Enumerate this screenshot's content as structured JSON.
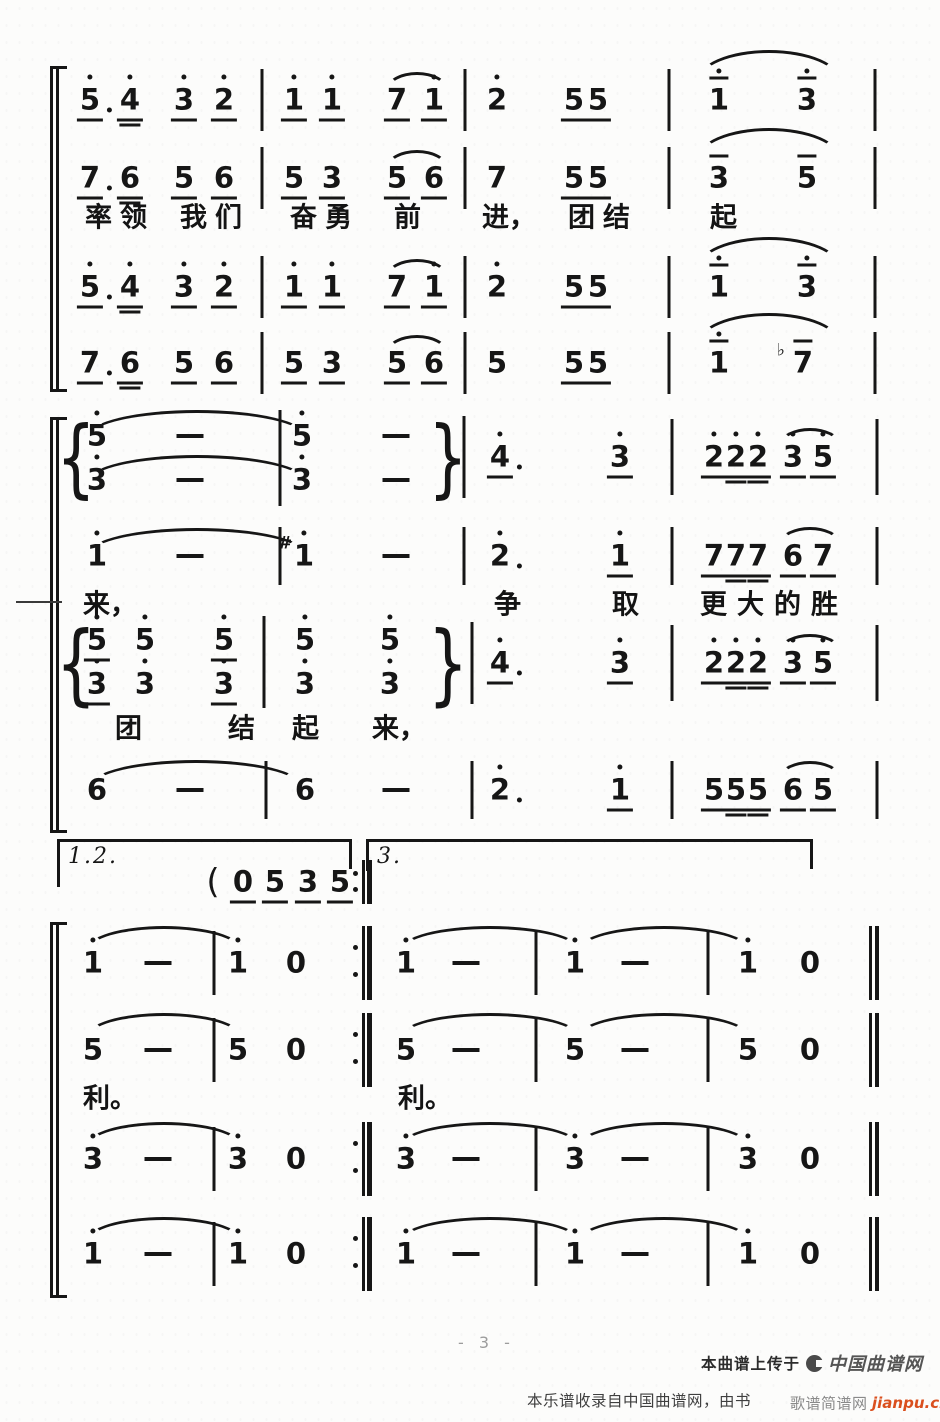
{
  "page": {
    "number_label": "- 3 -"
  },
  "footer": {
    "upload_prefix": "本曲谱上传于",
    "site_logo": "中国曲谱网",
    "source_note": "本乐谱收录自中国曲谱网，由书",
    "jianpu_site": "歌谱简谱网",
    "jianpu_domain": "jianpu.cn"
  },
  "colors": {
    "ink": "#161616",
    "paper": "#fcfcfb",
    "domain_red": "#da4f1e",
    "page_number_gray": "#9c9c9c"
  },
  "score": {
    "flag_legend": "d=octave dot above, u=single underline, U=double underline, o=overline, a=dot after, s=sharp, f=flat; '-'=duration dash, '0'=rest",
    "notes": [
      [
        90,
        100,
        "5",
        "dua"
      ],
      [
        130,
        100,
        "4",
        "dU"
      ],
      [
        184,
        100,
        "3",
        "du"
      ],
      [
        224,
        100,
        "2",
        "du"
      ],
      [
        294,
        100,
        "1",
        "du"
      ],
      [
        332,
        100,
        "1",
        "du"
      ],
      [
        397,
        100,
        "7",
        "u"
      ],
      [
        434,
        100,
        "1",
        "du"
      ],
      [
        497,
        100,
        "2",
        "d"
      ],
      [
        574,
        100,
        "5",
        "u"
      ],
      [
        598,
        100,
        "5",
        "u"
      ],
      [
        719,
        100,
        "1",
        "do"
      ],
      [
        807,
        100,
        "3",
        "do"
      ],
      [
        90,
        178,
        "7",
        "ua"
      ],
      [
        130,
        178,
        "6",
        "U"
      ],
      [
        184,
        178,
        "5",
        "u"
      ],
      [
        224,
        178,
        "6",
        "u"
      ],
      [
        294,
        178,
        "5",
        "u"
      ],
      [
        332,
        178,
        "3",
        "u"
      ],
      [
        397,
        178,
        "5",
        "u"
      ],
      [
        434,
        178,
        "6",
        "u"
      ],
      [
        497,
        178,
        "7",
        ""
      ],
      [
        574,
        178,
        "5",
        "u"
      ],
      [
        598,
        178,
        "5",
        "u"
      ],
      [
        719,
        178,
        "3",
        "o"
      ],
      [
        807,
        178,
        "5",
        "o"
      ],
      [
        90,
        287,
        "5",
        "dua"
      ],
      [
        130,
        287,
        "4",
        "dU"
      ],
      [
        184,
        287,
        "3",
        "du"
      ],
      [
        224,
        287,
        "2",
        "du"
      ],
      [
        294,
        287,
        "1",
        "du"
      ],
      [
        332,
        287,
        "1",
        "du"
      ],
      [
        397,
        287,
        "7",
        "u"
      ],
      [
        434,
        287,
        "1",
        "du"
      ],
      [
        497,
        287,
        "2",
        "d"
      ],
      [
        574,
        287,
        "5",
        "u"
      ],
      [
        598,
        287,
        "5",
        "u"
      ],
      [
        719,
        287,
        "1",
        "do"
      ],
      [
        807,
        287,
        "3",
        "do"
      ],
      [
        90,
        363,
        "7",
        "ua"
      ],
      [
        130,
        363,
        "6",
        "U"
      ],
      [
        184,
        363,
        "5",
        "u"
      ],
      [
        224,
        363,
        "6",
        "u"
      ],
      [
        294,
        363,
        "5",
        "u"
      ],
      [
        332,
        363,
        "3",
        "u"
      ],
      [
        397,
        363,
        "5",
        "u"
      ],
      [
        434,
        363,
        "6",
        "u"
      ],
      [
        497,
        363,
        "5",
        ""
      ],
      [
        574,
        363,
        "5",
        "u"
      ],
      [
        598,
        363,
        "5",
        "u"
      ],
      [
        719,
        363,
        "1",
        "do"
      ],
      [
        803,
        363,
        "7",
        "fo"
      ],
      [
        97,
        436,
        "5",
        "d"
      ],
      [
        190,
        436,
        "-",
        ""
      ],
      [
        302,
        436,
        "5",
        "d"
      ],
      [
        396,
        436,
        "-",
        ""
      ],
      [
        97,
        480,
        "3",
        "d"
      ],
      [
        190,
        480,
        "-",
        ""
      ],
      [
        302,
        480,
        "3",
        "d"
      ],
      [
        396,
        480,
        "-",
        ""
      ],
      [
        500,
        457,
        "4",
        "dua"
      ],
      [
        620,
        457,
        "3",
        "du"
      ],
      [
        714,
        457,
        "2",
        "du"
      ],
      [
        736,
        457,
        "2",
        "dU"
      ],
      [
        758,
        457,
        "2",
        "dU"
      ],
      [
        793,
        457,
        "3",
        "du"
      ],
      [
        823,
        457,
        "5",
        "du"
      ],
      [
        97,
        556,
        "1",
        "d"
      ],
      [
        190,
        556,
        "-",
        ""
      ],
      [
        304,
        556,
        "1",
        "ds"
      ],
      [
        396,
        556,
        "-",
        ""
      ],
      [
        500,
        556,
        "2",
        "da"
      ],
      [
        620,
        556,
        "1",
        "du"
      ],
      [
        714,
        556,
        "7",
        "u"
      ],
      [
        736,
        556,
        "7",
        "U"
      ],
      [
        758,
        556,
        "7",
        "U"
      ],
      [
        793,
        556,
        "6",
        "u"
      ],
      [
        823,
        556,
        "7",
        "u"
      ],
      [
        97,
        640,
        "5",
        "du"
      ],
      [
        145,
        640,
        "5",
        "d"
      ],
      [
        224,
        640,
        "5",
        "du"
      ],
      [
        305,
        640,
        "5",
        "d"
      ],
      [
        390,
        640,
        "5",
        "d"
      ],
      [
        97,
        684,
        "3",
        "du"
      ],
      [
        145,
        684,
        "3",
        "d"
      ],
      [
        224,
        684,
        "3",
        "du"
      ],
      [
        305,
        684,
        "3",
        "d"
      ],
      [
        390,
        684,
        "3",
        "d"
      ],
      [
        500,
        663,
        "4",
        "dua"
      ],
      [
        620,
        663,
        "3",
        "du"
      ],
      [
        714,
        663,
        "2",
        "du"
      ],
      [
        736,
        663,
        "2",
        "dU"
      ],
      [
        758,
        663,
        "2",
        "dU"
      ],
      [
        793,
        663,
        "3",
        "du"
      ],
      [
        823,
        663,
        "5",
        "du"
      ],
      [
        97,
        790,
        "6",
        ""
      ],
      [
        190,
        790,
        "-",
        ""
      ],
      [
        305,
        790,
        "6",
        ""
      ],
      [
        396,
        790,
        "-",
        ""
      ],
      [
        500,
        790,
        "2",
        "da"
      ],
      [
        620,
        790,
        "1",
        "du"
      ],
      [
        714,
        790,
        "5",
        "u"
      ],
      [
        736,
        790,
        "5",
        "U"
      ],
      [
        758,
        790,
        "5",
        "U"
      ],
      [
        793,
        790,
        "6",
        "u"
      ],
      [
        823,
        790,
        "5",
        "u"
      ],
      [
        213,
        882,
        "(",
        ""
      ],
      [
        243,
        882,
        "0",
        "u"
      ],
      [
        275,
        882,
        "5",
        "u"
      ],
      [
        308,
        882,
        "3",
        "u"
      ],
      [
        340,
        882,
        "5",
        "u"
      ],
      [
        93,
        963,
        "1",
        "d"
      ],
      [
        158,
        963,
        "-",
        ""
      ],
      [
        238,
        963,
        "1",
        "d"
      ],
      [
        296,
        963,
        "0",
        ""
      ],
      [
        406,
        963,
        "1",
        "d"
      ],
      [
        466,
        963,
        "-",
        ""
      ],
      [
        575,
        963,
        "1",
        "d"
      ],
      [
        635,
        963,
        "-",
        ""
      ],
      [
        748,
        963,
        "1",
        "d"
      ],
      [
        810,
        963,
        "0",
        ""
      ],
      [
        93,
        1050,
        "5",
        ""
      ],
      [
        158,
        1050,
        "-",
        ""
      ],
      [
        238,
        1050,
        "5",
        ""
      ],
      [
        296,
        1050,
        "0",
        ""
      ],
      [
        406,
        1050,
        "5",
        ""
      ],
      [
        466,
        1050,
        "-",
        ""
      ],
      [
        575,
        1050,
        "5",
        ""
      ],
      [
        635,
        1050,
        "-",
        ""
      ],
      [
        748,
        1050,
        "5",
        ""
      ],
      [
        810,
        1050,
        "0",
        ""
      ],
      [
        93,
        1159,
        "3",
        "d"
      ],
      [
        158,
        1159,
        "-",
        ""
      ],
      [
        238,
        1159,
        "3",
        "d"
      ],
      [
        296,
        1159,
        "0",
        ""
      ],
      [
        406,
        1159,
        "3",
        "d"
      ],
      [
        466,
        1159,
        "-",
        ""
      ],
      [
        575,
        1159,
        "3",
        "d"
      ],
      [
        635,
        1159,
        "-",
        ""
      ],
      [
        748,
        1159,
        "3",
        "d"
      ],
      [
        810,
        1159,
        "0",
        ""
      ],
      [
        93,
        1254,
        "1",
        "d"
      ],
      [
        158,
        1254,
        "-",
        ""
      ],
      [
        238,
        1254,
        "1",
        "d"
      ],
      [
        296,
        1254,
        "0",
        ""
      ],
      [
        406,
        1254,
        "1",
        "d"
      ],
      [
        466,
        1254,
        "-",
        ""
      ],
      [
        575,
        1254,
        "1",
        "d"
      ],
      [
        635,
        1254,
        "-",
        ""
      ],
      [
        748,
        1254,
        "1",
        "d"
      ],
      [
        810,
        1254,
        "0",
        ""
      ]
    ],
    "bars": [
      [
        262,
        100,
        62
      ],
      [
        465,
        100,
        62
      ],
      [
        669,
        100,
        62
      ],
      [
        875,
        100,
        62
      ],
      [
        262,
        178,
        62
      ],
      [
        465,
        178,
        62
      ],
      [
        669,
        178,
        62
      ],
      [
        875,
        178,
        62
      ],
      [
        262,
        287,
        62
      ],
      [
        465,
        287,
        62
      ],
      [
        669,
        287,
        62
      ],
      [
        875,
        287,
        62
      ],
      [
        262,
        363,
        62
      ],
      [
        465,
        363,
        62
      ],
      [
        669,
        363,
        62
      ],
      [
        875,
        363,
        62
      ],
      [
        280,
        436,
        52
      ],
      [
        280,
        480,
        52
      ],
      [
        464,
        457,
        82
      ],
      [
        672,
        457,
        76
      ],
      [
        877,
        457,
        76
      ],
      [
        280,
        556,
        58
      ],
      [
        464,
        556,
        58
      ],
      [
        672,
        556,
        58
      ],
      [
        877,
        556,
        58
      ],
      [
        264,
        640,
        48
      ],
      [
        264,
        684,
        48
      ],
      [
        472,
        663,
        82
      ],
      [
        672,
        663,
        76
      ],
      [
        877,
        663,
        76
      ],
      [
        266,
        790,
        58
      ],
      [
        472,
        790,
        58
      ],
      [
        672,
        790,
        58
      ],
      [
        877,
        790,
        58
      ],
      [
        214,
        963,
        64
      ],
      [
        536,
        963,
        64
      ],
      [
        708,
        963,
        64
      ],
      [
        214,
        1050,
        64
      ],
      [
        536,
        1050,
        64
      ],
      [
        708,
        1050,
        64
      ],
      [
        214,
        1159,
        64
      ],
      [
        536,
        1159,
        64
      ],
      [
        708,
        1159,
        64
      ],
      [
        214,
        1254,
        64
      ],
      [
        536,
        1254,
        64
      ],
      [
        708,
        1254,
        64
      ]
    ],
    "finals": [
      [
        874,
        963,
        74
      ],
      [
        874,
        1050,
        74
      ],
      [
        874,
        1159,
        74
      ],
      [
        874,
        1254,
        74
      ]
    ],
    "repeats": [
      [
        362,
        882,
        44
      ],
      [
        362,
        963,
        74
      ],
      [
        362,
        1050,
        74
      ],
      [
        362,
        1159,
        74
      ],
      [
        362,
        1254,
        74
      ]
    ],
    "arcs": [
      [
        386,
        72,
        62,
        18
      ],
      [
        696,
        50,
        146,
        32
      ],
      [
        386,
        150,
        62,
        18
      ],
      [
        696,
        128,
        146,
        32
      ],
      [
        386,
        259,
        62,
        18
      ],
      [
        696,
        237,
        146,
        32
      ],
      [
        386,
        335,
        62,
        18
      ],
      [
        696,
        313,
        146,
        32
      ],
      [
        88,
        410,
        218,
        26
      ],
      [
        88,
        455,
        218,
        26
      ],
      [
        780,
        428,
        60,
        16
      ],
      [
        88,
        528,
        218,
        26
      ],
      [
        780,
        527,
        60,
        16
      ],
      [
        780,
        634,
        60,
        16
      ],
      [
        90,
        760,
        212,
        26
      ],
      [
        780,
        761,
        60,
        16
      ],
      [
        86,
        926,
        156,
        24
      ],
      [
        400,
        926,
        180,
        24
      ],
      [
        578,
        926,
        172,
        24
      ],
      [
        86,
        1013,
        156,
        24
      ],
      [
        400,
        1013,
        180,
        24
      ],
      [
        578,
        1013,
        172,
        24
      ],
      [
        86,
        1122,
        156,
        24
      ],
      [
        400,
        1122,
        180,
        24
      ],
      [
        578,
        1122,
        172,
        24
      ],
      [
        86,
        1217,
        156,
        24
      ],
      [
        400,
        1217,
        180,
        24
      ],
      [
        578,
        1217,
        172,
        24
      ]
    ],
    "braces": [
      [
        76,
        458,
        84,
        "{"
      ],
      [
        448,
        458,
        84,
        "}"
      ],
      [
        76,
        664,
        86,
        "{"
      ],
      [
        448,
        664,
        86,
        "}"
      ]
    ],
    "brackets": [
      [
        50,
        66,
        392
      ],
      [
        50,
        417,
        833
      ],
      [
        50,
        922,
        1298
      ]
    ],
    "voltas": [
      {
        "x1": 57,
        "x2": 352,
        "y": 839,
        "label": "1.2.",
        "tl": 48,
        "tr": 30
      },
      {
        "x1": 366,
        "x2": 813,
        "y": 839,
        "label": "3.",
        "tl": 32,
        "tr": 30
      }
    ],
    "lyrics": [
      [
        85,
        215,
        "率领",
        8
      ],
      [
        180,
        215,
        "我们",
        8
      ],
      [
        290,
        215,
        "奋勇",
        8
      ],
      [
        394,
        215,
        "前",
        0
      ],
      [
        482,
        215,
        "进，",
        0
      ],
      [
        568,
        215,
        "团结",
        8
      ],
      [
        710,
        215,
        "起",
        0
      ],
      [
        83,
        602,
        "来，",
        0
      ],
      [
        494,
        602,
        "争",
        0
      ],
      [
        612,
        602,
        "取",
        0
      ],
      [
        700,
        602,
        "更大的胜",
        10
      ],
      [
        115,
        726,
        "团",
        0
      ],
      [
        228,
        726,
        "结",
        0
      ],
      [
        292,
        726,
        "起",
        0
      ],
      [
        372,
        726,
        "来，",
        0
      ],
      [
        83,
        1096,
        "利。",
        0
      ],
      [
        398,
        1096,
        "利。",
        0
      ]
    ],
    "marks": [
      [
        16,
        601,
        46
      ]
    ]
  }
}
